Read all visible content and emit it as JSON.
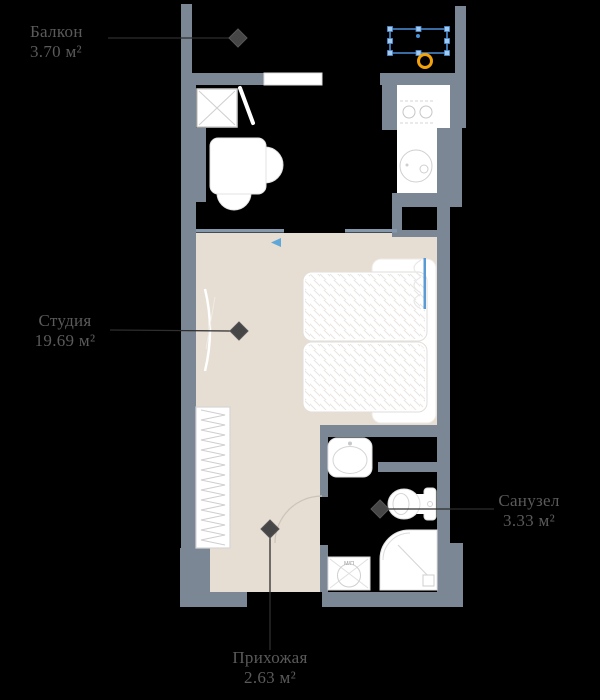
{
  "plan": {
    "rooms": [
      {
        "id": "balcony",
        "name": "Балкон",
        "area": "3.70 м²"
      },
      {
        "id": "studio",
        "name": "Студия",
        "area": "19.69 м²"
      },
      {
        "id": "bathroom",
        "name": "Санузел",
        "area": "3.33 м²"
      },
      {
        "id": "hallway",
        "name": "Прихожая",
        "area": "2.63 м²"
      }
    ],
    "appliance_label": "М/П",
    "icons": {
      "bathtub-icon": "blue selected rectangle with handles on balcony",
      "ring-highlight-icon": "orange circle outline",
      "wardrobe-x-icon": "square crossed with X",
      "table-chairs-icon": "white table with two round chairs",
      "stove-icon": "two burner circles",
      "kitchen-sink-icon": "round sink",
      "bed-icon": "double bed with hatched mattress and pillows",
      "closet-icon": "rectangle with zigzag hanger line",
      "wash-basin-icon": "rounded basin with faucet dot",
      "toilet-icon": "bowl with cistern",
      "shower-icon": "quarter-round tray with drain",
      "washing-machine-icon": "square with crossed drum circle",
      "area-marker-icon": "dark diamond with leader line"
    },
    "colors": {
      "background": "#000000",
      "wall": "#7b8794",
      "floor": "#e6ddd3",
      "fixture": "#ffffff",
      "partition": "#8598ab",
      "selection_blue": "#4a90d9",
      "highlight_orange": "#f2a30b",
      "label_text": "#5a5a5a",
      "marker": "#464646"
    }
  }
}
